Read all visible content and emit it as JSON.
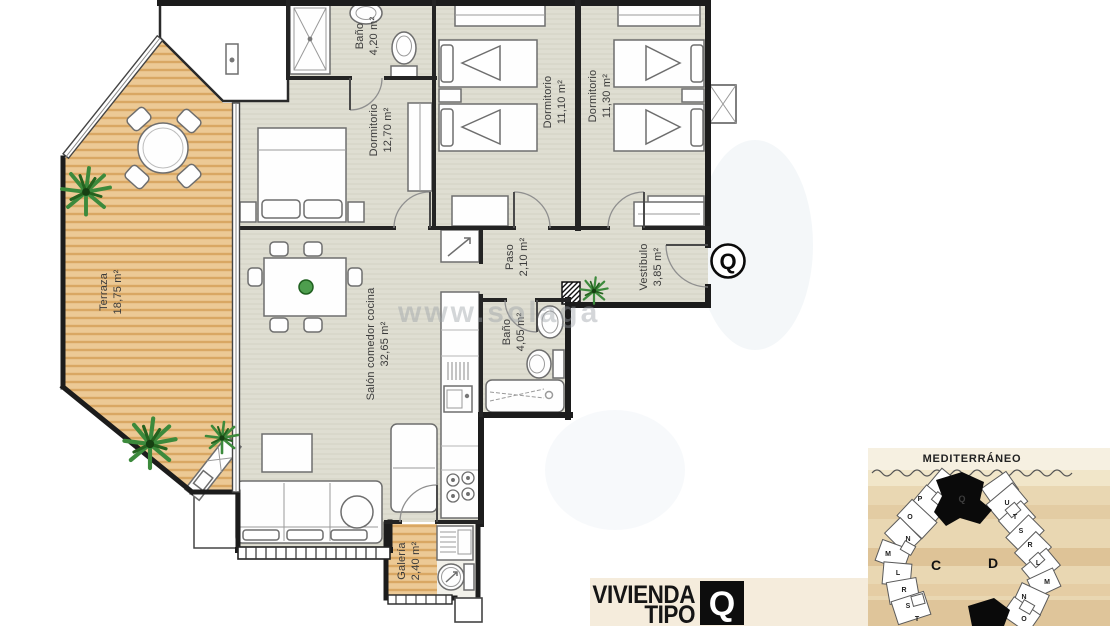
{
  "plan": {
    "rooms": [
      {
        "name": "Terraza",
        "area": "18,75 m²"
      },
      {
        "name": "Baño",
        "area": "4,20 m²"
      },
      {
        "name": "Dormitorio",
        "area": "12,70 m²"
      },
      {
        "name": "Dormitorio",
        "area": "11,10 m²"
      },
      {
        "name": "Dormitorio",
        "area": "11,30 m²"
      },
      {
        "name": "Paso",
        "area": "2,10 m²"
      },
      {
        "name": "Vestíbulo",
        "area": "3,85 m²"
      },
      {
        "name": "Salón comedor cocina",
        "area": "32,65 m²"
      },
      {
        "name": "Baño",
        "area": "4,05 m²"
      },
      {
        "name": "Galería",
        "area": "2,40 m²"
      }
    ],
    "unit_badge": "Q"
  },
  "watermark": "www.solaga",
  "caption": {
    "line1": "VIVIENDA",
    "line2": "TIPO",
    "badge": "Q"
  },
  "site_plan": {
    "sea_label": "MEDITERRÁNEO",
    "blocks": [
      "C",
      "D"
    ],
    "left_units": [
      "P",
      "O",
      "N",
      "M",
      "L",
      "R",
      "S",
      "T"
    ],
    "right_units": [
      "U",
      "T",
      "S",
      "R",
      "L",
      "M",
      "N",
      "O"
    ],
    "highlighted_unit": "Q"
  }
}
